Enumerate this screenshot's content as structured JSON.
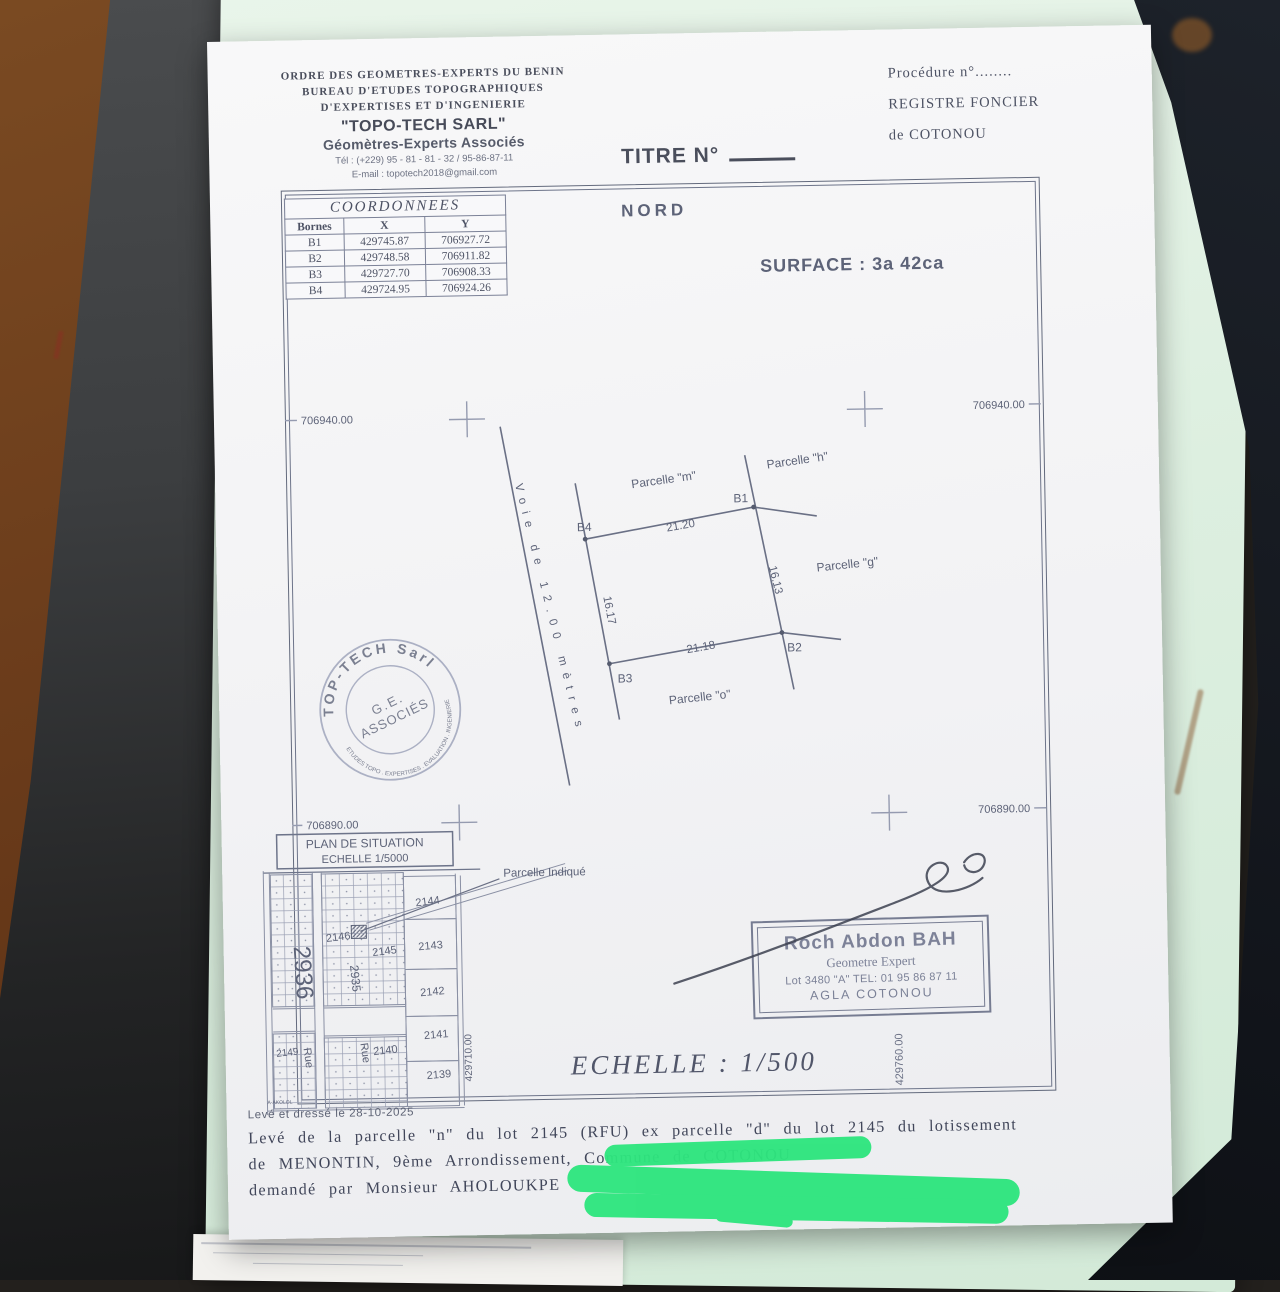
{
  "letterhead": {
    "lines": [
      "ORDRE DES GEOMETRES-EXPERTS DU BENIN",
      "BUREAU D'ETUDES TOPOGRAPHIQUES",
      "D'EXPERTISES ET D'INGENIERIE"
    ],
    "company": "\"TOPO-TECH SARL\"",
    "subtitle": "Géomètres-Experts Associés",
    "tel": "Tél : (+229) 95 - 81 - 81 - 32 / 95-86-87-11",
    "email": "E-mail : topotech2018@gmail.com"
  },
  "registry": {
    "procedure": "Procédure n°........",
    "register": "REGISTRE FONCIER",
    "city": "de COTONOU"
  },
  "title": {
    "label": "TITRE N°"
  },
  "coords": {
    "title": "COORDONNEES",
    "headers": [
      "Bornes",
      "X",
      "Y"
    ],
    "rows": [
      [
        "B1",
        "429745.87",
        "706927.72"
      ],
      [
        "B2",
        "429748.58",
        "706911.82"
      ],
      [
        "B3",
        "429727.70",
        "706908.33"
      ],
      [
        "B4",
        "429724.95",
        "706924.26"
      ]
    ]
  },
  "plan": {
    "north": "NORD",
    "surface": "SURFACE  : 3a 42ca",
    "grid": {
      "nw": "706940.00",
      "ne": "706940.00",
      "sw": "706890.00",
      "se": "706890.00"
    },
    "parcels": {
      "m": "Parcelle \"m\"",
      "h": "Parcelle \"h\"",
      "g": "Parcelle \"g\"",
      "o": "Parcelle \"o\""
    },
    "bornes": {
      "b1": "B1",
      "b2": "B2",
      "b3": "B3",
      "b4": "B4"
    },
    "dims": {
      "top": "21.20",
      "right": "16.13",
      "left": "16.17",
      "bottom": "21.18"
    },
    "voie": "Voie de 12.00 mètres"
  },
  "stamp": {
    "top": "TOP-TECH Sarl",
    "center1": "G.E.",
    "center2": "ASSOCIÉS",
    "bottom": "ETUDES TOPO . EXPERTISES . EVALUATION . INGENIERIE"
  },
  "situation": {
    "title": "PLAN DE SITUATION",
    "scale": "ECHELLE 1/5000",
    "indicated": "Parcelle Indiquée",
    "rue1": "Rue",
    "rue2": "Rue",
    "street": "A-AKOLOL",
    "coord_w": "429710.00",
    "lots": {
      "n2936": "2936",
      "n2935": "2935",
      "n2146": "2146",
      "n2145": "2145",
      "n2144": "2144",
      "n2143": "2143",
      "n2142": "2142",
      "n2141": "2141",
      "n2140": "2140",
      "n2139": "2139",
      "n2149": "2149"
    }
  },
  "signature": {
    "name": "Roch Abdon BAH",
    "role": "Geometre Expert",
    "line3": "Lot 3480 \"A\" TEL: 01 95 86 87 11",
    "city": "AGLA COTONOU",
    "easting": "429760.00"
  },
  "scale_main": "ECHELLE : 1/500",
  "footer": {
    "drawn": "Levé et dressé le 28-10-2025",
    "line1": "Levé de la parcelle \"n\" du lot 2145 (RFU) ex parcelle \"d\" du lot 2145 du lotissement",
    "line2": "de MENONTIN, 9ème Arrondissement, Commune de COTONOU",
    "line3": "demandé par Monsieur AHOLOUKPE"
  }
}
